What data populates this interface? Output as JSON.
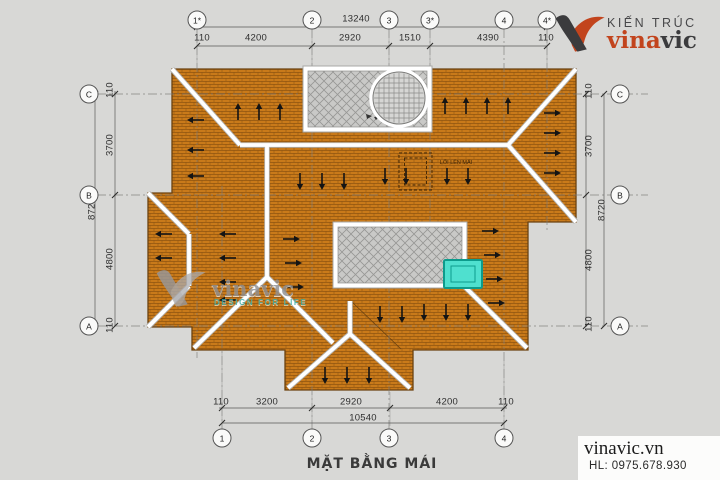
{
  "title": "MẶT BẰNG MÁI",
  "logo": {
    "tagline": "KIẾN TRÚC",
    "brand_red": "vina",
    "brand_dark": "vic"
  },
  "watermark": {
    "brand": "vinavic",
    "tagline": "DESIGN FOR LIFE"
  },
  "contact": {
    "website": "vinavic.vn",
    "hotline": "HL: 0975.678.930"
  },
  "annotations": {
    "roof_access": "LỐI LÊN MÁI"
  },
  "grids": {
    "top": [
      "1*",
      "2",
      "3",
      "3*",
      "4",
      "4*"
    ],
    "bottom": [
      "1",
      "2",
      "3",
      "4"
    ],
    "left": [
      "C",
      "B",
      "A"
    ],
    "right": [
      "C",
      "B",
      "A"
    ]
  },
  "dimensions": {
    "top": {
      "segments": [
        "110",
        "4200",
        "2920",
        "1510",
        "4390",
        "110"
      ],
      "total": "13240"
    },
    "bottom": {
      "segments": [
        "110",
        "3200",
        "2920",
        "4200",
        "110"
      ],
      "total": "10540"
    },
    "left": {
      "segments": [
        "110",
        "3700",
        "4800",
        "110"
      ],
      "total": "8720"
    },
    "right": {
      "segments": [
        "110",
        "3700",
        "4800",
        "110"
      ],
      "total": "8720"
    }
  },
  "colors": {
    "bg": "#d8d8d6",
    "tile": "#c97a1a",
    "tileline": "#8f5410",
    "outline": "#6b4210",
    "ridge": "#ffffff",
    "ridgeedge": "#b2b2b0",
    "hatchbg": "#c9c9c7",
    "hatchline": "#979795",
    "tank": "#4fe0cf",
    "tankborder": "#0d9b8c",
    "arrow": "#141414",
    "dim": "#2e2e2e",
    "grid": "#7c7c7a",
    "logored": "#c2441d",
    "logodark": "#3b3b3d",
    "wmgray": "#909092",
    "wmteal": "#3aaea6",
    "title": "#3a3a3a"
  },
  "arrows": [
    [
      238,
      112,
      "u"
    ],
    [
      259,
      112,
      "u"
    ],
    [
      280,
      112,
      "u"
    ],
    [
      445,
      106,
      "u"
    ],
    [
      466,
      106,
      "u"
    ],
    [
      487,
      106,
      "u"
    ],
    [
      508,
      106,
      "u"
    ],
    [
      552,
      113,
      "r"
    ],
    [
      552,
      133,
      "r"
    ],
    [
      552,
      153,
      "r"
    ],
    [
      552,
      173,
      "r"
    ],
    [
      291,
      239,
      "r"
    ],
    [
      293,
      263,
      "r"
    ],
    [
      295,
      287,
      "r"
    ],
    [
      490,
      231,
      "r"
    ],
    [
      492,
      255,
      "r"
    ],
    [
      494,
      279,
      "r"
    ],
    [
      496,
      303,
      "r"
    ],
    [
      196,
      120,
      "l"
    ],
    [
      196,
      150,
      "l"
    ],
    [
      196,
      176,
      "l"
    ],
    [
      228,
      234,
      "l"
    ],
    [
      228,
      258,
      "l"
    ],
    [
      228,
      282,
      "l"
    ],
    [
      228,
      300,
      "l"
    ],
    [
      164,
      234,
      "l"
    ],
    [
      164,
      258,
      "l"
    ],
    [
      300,
      181,
      "d"
    ],
    [
      322,
      181,
      "d"
    ],
    [
      344,
      181,
      "d"
    ],
    [
      385,
      176,
      "d"
    ],
    [
      406,
      176,
      "d"
    ],
    [
      447,
      176,
      "d"
    ],
    [
      468,
      176,
      "d"
    ],
    [
      380,
      314,
      "d"
    ],
    [
      402,
      314,
      "d"
    ],
    [
      424,
      312,
      "d"
    ],
    [
      446,
      312,
      "d"
    ],
    [
      468,
      312,
      "d"
    ],
    [
      325,
      375,
      "d"
    ],
    [
      347,
      375,
      "d"
    ],
    [
      369,
      375,
      "d"
    ]
  ]
}
